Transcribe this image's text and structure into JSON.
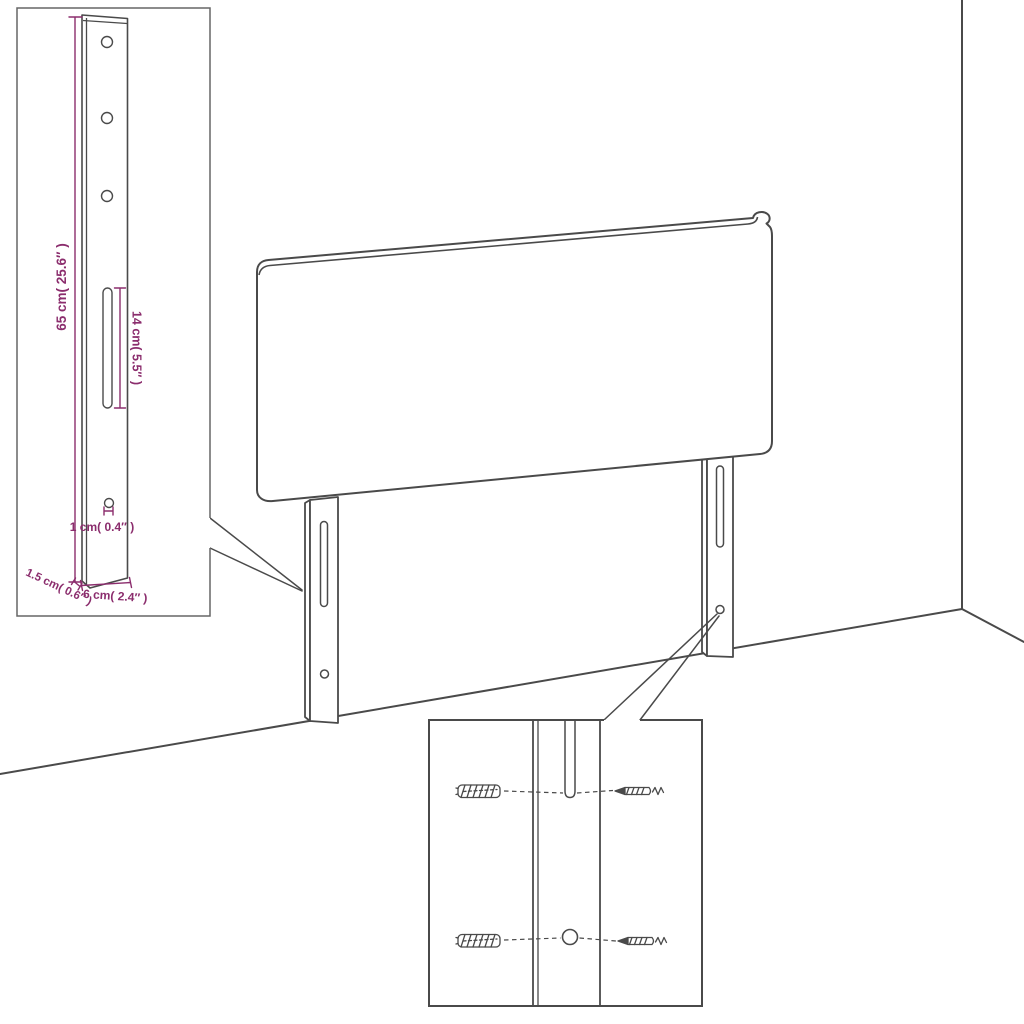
{
  "diagram": {
    "title": "headboard wall-mounting assembly diagram",
    "colors": {
      "line": "#4a4a4a",
      "accent": "#8b2d6d",
      "background": "#ffffff"
    },
    "dimensions": {
      "bracket_height": "65 cm( 25.6″ )",
      "slot_length": "14 cm( 5.5″ )",
      "hole_diameter": "1 cm( 0.4″ )",
      "bracket_depth": "1.5 cm( 0.6″ )",
      "bracket_width": "6 cm( 2.4″ )"
    }
  }
}
